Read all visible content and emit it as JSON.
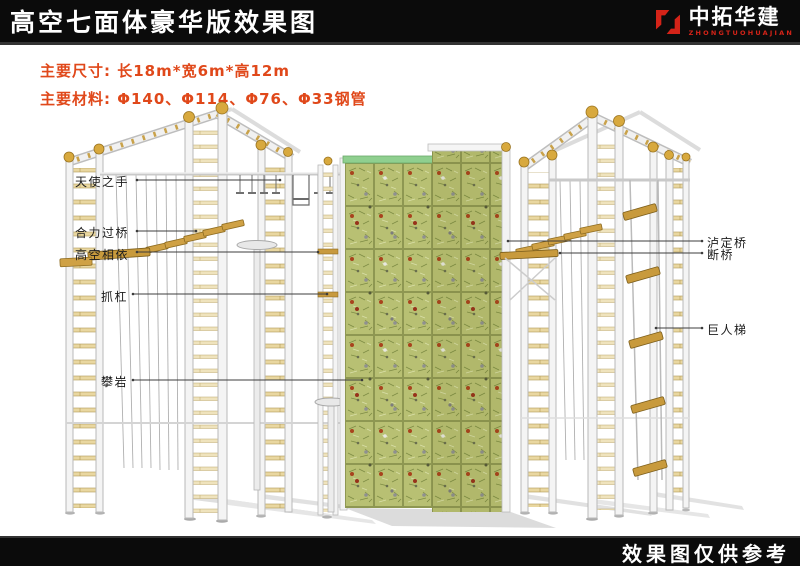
{
  "header": {
    "title": "高空七面体豪华版效果图"
  },
  "logo": {
    "name": "中拓华建",
    "subtitle": "ZHONGTUOHUAJIAN",
    "icon": "interlocked-hooks-logo-icon",
    "accent_color": "#d42318"
  },
  "specs": {
    "dimensions": "主要尺寸: 长18m*宽6m*高12m",
    "materials": "主要材料: Φ140、Φ114、Φ76、Φ33钢管",
    "text_color": "#e0481a"
  },
  "callouts": {
    "left": [
      {
        "label": "天使之手"
      },
      {
        "label": "合力过桥"
      },
      {
        "label": "高空相依"
      },
      {
        "label": "抓杠"
      },
      {
        "label": "攀岩"
      }
    ],
    "right": [
      {
        "label": "泸定桥"
      },
      {
        "label": "断桥"
      },
      {
        "label": "巨人梯"
      }
    ]
  },
  "footer": {
    "note": "效果图仅供参考"
  },
  "scene": {
    "description": "3D rendering of high-altitude seven-sided climbing structure",
    "colors": {
      "wall_green": "#b8c073",
      "wall_grid": "#8e9752",
      "wood": "#cfa145",
      "steel": "#f2f2f2",
      "ball_gold": "#d8a93e",
      "bar_black": "#0b0b0b"
    }
  }
}
